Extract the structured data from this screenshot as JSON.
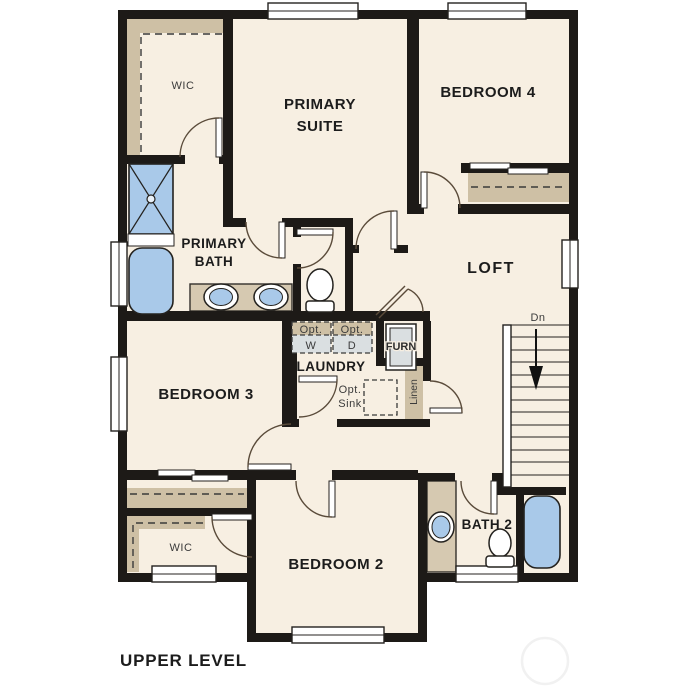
{
  "plan_title": "UPPER LEVEL",
  "rooms": {
    "wic_upper": {
      "label": "WIC"
    },
    "primary_suite": {
      "label": "PRIMARY SUITE",
      "lines": [
        "PRIMARY",
        "SUITE"
      ]
    },
    "bedroom4": {
      "label": "BEDROOM 4"
    },
    "primary_bath": {
      "label": "PRIMARY BATH",
      "lines": [
        "PRIMARY",
        "BATH"
      ]
    },
    "loft": {
      "label": "LOFT"
    },
    "laundry": {
      "label": "LAUNDRY"
    },
    "bedroom3": {
      "label": "BEDROOM 3"
    },
    "bedroom2": {
      "label": "BEDROOM 2"
    },
    "bath2": {
      "label": "BATH 2"
    },
    "wic_lower": {
      "label": "WIC"
    }
  },
  "fixtures": {
    "washer_opt": {
      "line1": "Opt.",
      "line2": "W"
    },
    "dryer_opt": {
      "line1": "Opt.",
      "line2": "D"
    },
    "sink_opt": {
      "line1": "Opt.",
      "line2": "Sink"
    },
    "furnace": "FURN",
    "linen": "Linen",
    "stairs_down": "Dn"
  },
  "colors": {
    "floor": "#f7efe2",
    "wall": "#1d1a17",
    "shelf_tan": "#cec0a5",
    "counter_tan": "#d6c9b1",
    "fixture_blue": "#a9c9e9",
    "appliance_gray": "#dadfe1",
    "watermark": "#f1f1f1"
  }
}
